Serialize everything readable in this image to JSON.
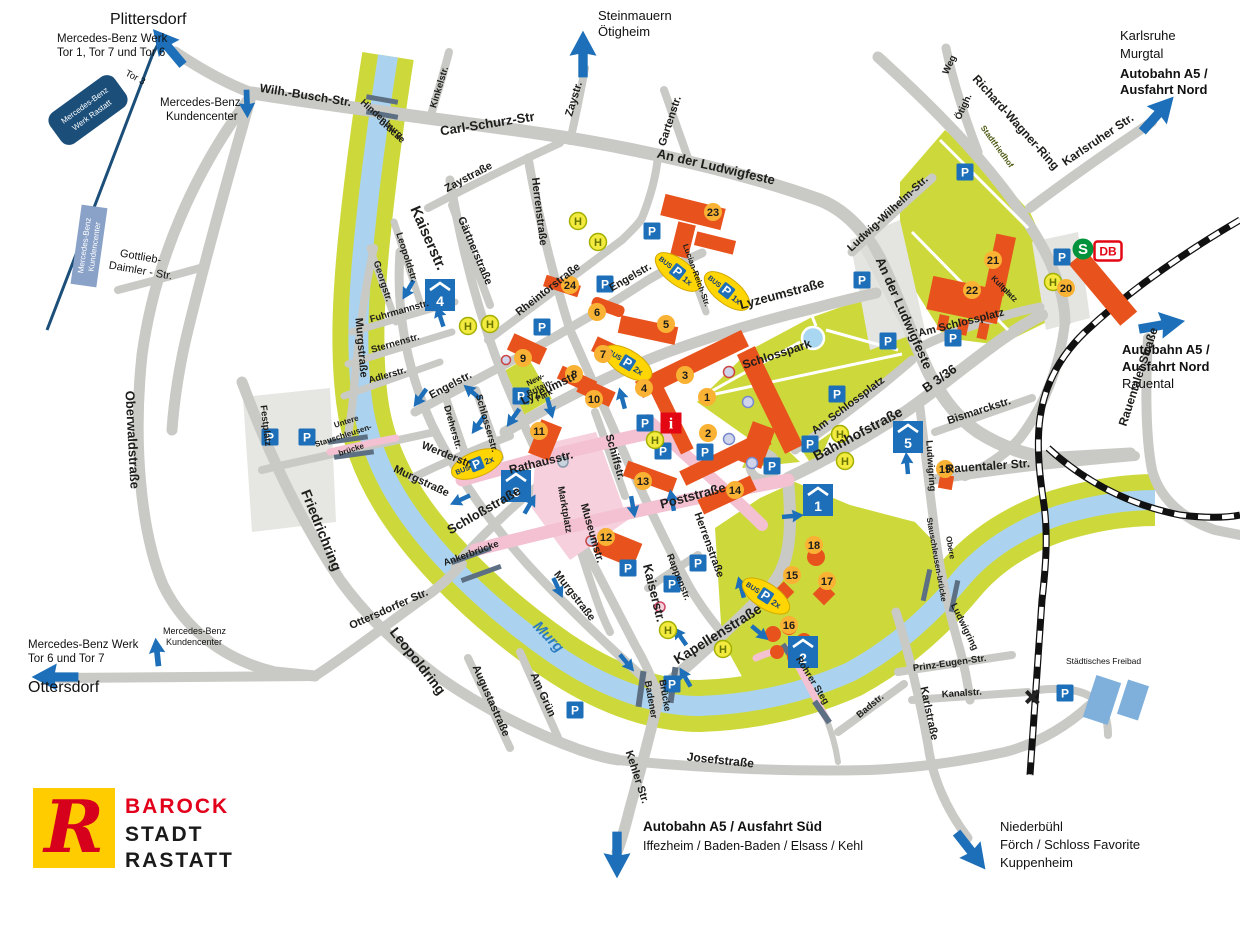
{
  "map_title": "Barock Stadt Rastatt – Stadtplan / Anfahrt",
  "logo": {
    "r": "R",
    "barock": "BAROCK",
    "stadt": "STADT",
    "rastatt": "RASTATT"
  },
  "icons": {
    "p": "P",
    "h": "H",
    "i": "i",
    "s": "S",
    "db": "DB",
    "bus": "BUS",
    "x1": "1x",
    "x2": "2x"
  },
  "colors": {
    "road": "#c9c9c5",
    "river": "#abd3ef",
    "green": "#cdd93b",
    "building": "#e8531d",
    "pedestrian": "#f3c1d1",
    "parking_blue": "#1c6fb8",
    "badge_orange": "#f9b233",
    "info_red": "#e30613",
    "sbahn_green": "#00933b",
    "db_red": "#e30613",
    "logo_yellow": "#ffcc00",
    "logo_red": "#d6001c",
    "mercedes_navy": "#1b4e79"
  },
  "destinations": {
    "plittersdorf": "Plittersdorf",
    "mb_werk_nord_1": "Mercedes-Benz Werk",
    "mb_werk_nord_2": "Tor 1, Tor 7 und Tor 6",
    "tor3": "Tor 3",
    "mb_box_1": "Mercedes-Benz",
    "mb_box_2": "Werk Rastatt",
    "kundencenter_n_1": "Mercedes-Benz",
    "kundencenter_n_2": "Kundencenter",
    "kundencenter_box_1": "Mercedes-Benz",
    "kundencenter_box_2": "Kundencenter",
    "gottlieb_1": "Gottlieb-",
    "gottlieb_2": "Daimler - Str.",
    "steinmauern": "Steinmauern",
    "oetigheim": "Ötigheim",
    "karlsruhe": "Karlsruhe",
    "murgtal": "Murgtal",
    "a5_nord_1": "Autobahn A5 /",
    "a5_nord_2": "Ausfahrt Nord",
    "a5_nord_r1": "Autobahn A5 /",
    "a5_nord_r2": "Ausfahrt Nord",
    "rauental": "Rauental",
    "mb_werk_sued_1": "Mercedes-Benz Werk",
    "mb_werk_sued_2": "Tor 6 und Tor 7",
    "ottersdorf": "Ottersdorf",
    "kundencenter_s_1": "Mercedes-Benz",
    "kundencenter_s_2": "Kundencenter",
    "a5_sued_1": "Autobahn A5 / Ausfahrt Süd",
    "a5_sued_2": "Iffezheim / Baden-Baden / Elsass / Kehl",
    "niederbuehl": "Niederbühl",
    "foerch": "Förch / Schloss Favorite",
    "kuppenheim": "Kuppenheim",
    "freibad": "Städtisches Freibad"
  },
  "streets": {
    "wilh_busch": "Wilh.-Busch-Str.",
    "hindenburg_1": "Hindenburg-",
    "hindenburg_2": "brücke",
    "kinkelstr": "Kinkelstr.",
    "carl_schurz": "Carl-Schurz-Str",
    "zaystr": "Zaystr.",
    "zaystrasse": "Zaystraße",
    "gartenstr": "Gartenstr.",
    "ludwigfeste_top": "An der Ludwigfeste",
    "ludwigfeste_right": "An der Ludwigfeste",
    "richard_wagner": "Richard-Wagner-Ring",
    "oetigh": "Ötigh.",
    "weg": "Weg",
    "stadtfriedhof": "Stadtfriedhof",
    "karlsruher_str": "Karlsruher Str.",
    "ludwig_wilhelm": "Ludwig-Wilhelm-Str.",
    "herrenstrasse_n": "Herrenstraße",
    "herrenstrasse_s": "Herrenstraße",
    "gaertnerstrasse": "Gärtnerstraße",
    "rheintorstrasse": "Rheintorstraße",
    "kaiserstr_n": "Kaiserstr.",
    "kaiserstr_m": "Kaiserstr.",
    "kaiserstr_s": "Kaiserstr.",
    "leopoldstr": "Leopoldstr.",
    "georgstr": "Georgstr.",
    "fuhrmannstr": "Fuhrmannstr.",
    "sternenstr": "Sternenstr.",
    "adlerstr": "Adlerstr.",
    "murgstrasse_nw": "Murgstraße",
    "murgstrasse_w": "Murgstraße",
    "murgstrasse_s": "Murgstraße",
    "engelstr_w": "Engelstr.",
    "engelstr_e": "Engelstr.",
    "lucian_reich": "Lucian-Reich-Str.",
    "dreherstr": "Dreherstr.",
    "schlosserstr": "Schlosserstr.",
    "werderstr": "Werderstr.",
    "festplatz": "Festplatz",
    "untere_1": "Untere",
    "untere_2": "Stauschleusen-",
    "untere_3": "brücke",
    "friedrichring": "Friedrichring",
    "oberwaldstrasse": "Oberwaldstraße",
    "ottersdorfer_str": "Ottersdorfer Str.",
    "leopoldring": "Leopoldring",
    "murg": "Murg",
    "ankerbruecke": "Ankerbrücke",
    "augustastrasse": "Augustastraße",
    "am_gruen": "Am Grün",
    "badener_1": "Badener",
    "badener_2": "Brücke",
    "kehler_str": "Kehler Str.",
    "josefstrasse": "Josefstraße",
    "rohrer_steg": "Rohrer Steg",
    "schlossstrasse": "Schloßstraße",
    "rathausstr": "Rathausstr.",
    "marktplatz": "Marktplatz",
    "schiffstr": "Schiffstr.",
    "museumstr": "Museumstr.",
    "lyzeumstr": "Lyzeumstr",
    "lyzeumstrasse": "Lyzeumstraße",
    "poststrasse": "Poststraße",
    "rappenstr": "Rappenstr.",
    "kapellenstrasse": "Kapellenstraße",
    "new_britain_1": "New-",
    "new_britain_2": "Britain-",
    "new_britain_3": "Park",
    "schlosspark": "Schlosspark",
    "am_schlossplatz_w": "Am Schlossplatz",
    "am_schlossplatz_e": "Am Schlossplatz",
    "kultur_1": "Kultur-",
    "kultur_2": "platz",
    "bahnhofstrasse": "Bahnhofstraße",
    "b336": "B 3/36",
    "bismarckstr": "Bismarckstr.",
    "ludwigring_n": "Ludwigring",
    "ludwigring_s": "Ludwigring",
    "rauentaler_str": "Rauentaler Str.",
    "rauentaler_strasse": "Rauentaler Straße",
    "obere_1": "Obere",
    "obere_2": "Stauschleusen-brücke",
    "prinz_eugen": "Prinz-Eugen-Str.",
    "kanalstr": "Kanalstr.",
    "karlstrasse": "Karlstraße",
    "badstr": "Badstr."
  },
  "markers": {
    "m1": "1",
    "m2": "2",
    "m3": "3",
    "m4": "4",
    "m5": "5",
    "m6": "6",
    "m7": "7",
    "m8": "8",
    "m9": "9",
    "m10": "10",
    "m11": "11",
    "m12": "12",
    "m13": "13",
    "m14": "14",
    "m15": "15",
    "m16": "16",
    "m17": "17",
    "m18": "18",
    "m19": "19",
    "m20": "20",
    "m21": "21",
    "m22": "22",
    "m23": "23",
    "m24": "24"
  },
  "garages": {
    "g1": "1",
    "g2": "2",
    "g3": "3",
    "g4": "4",
    "g5": "5"
  }
}
